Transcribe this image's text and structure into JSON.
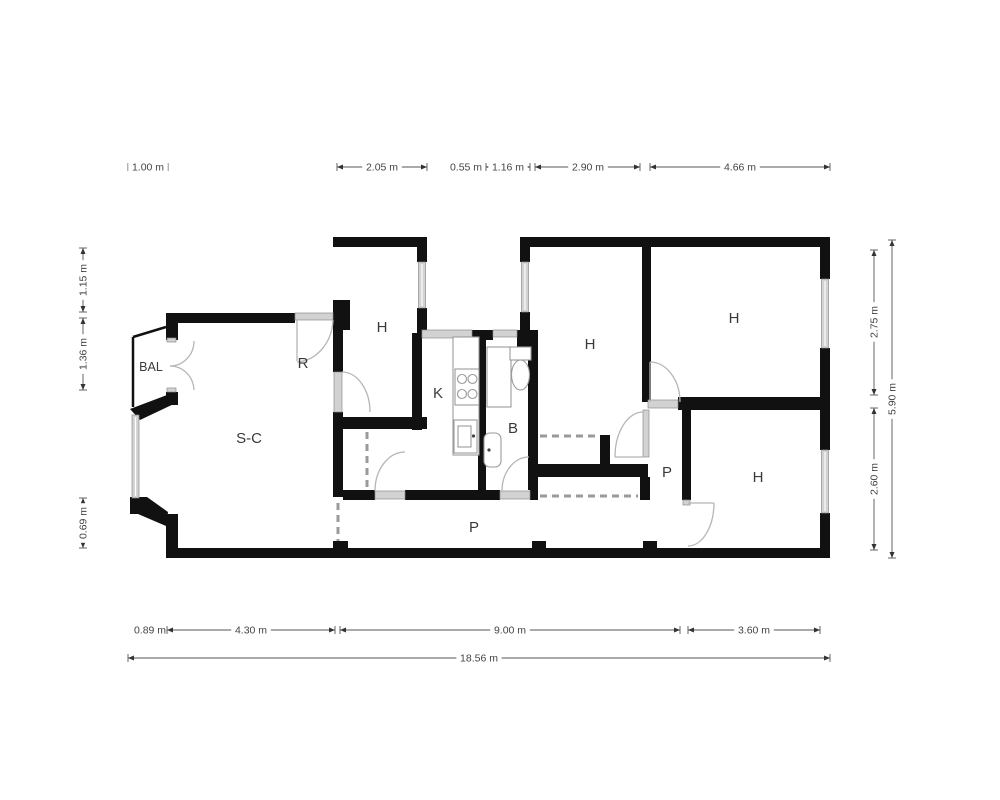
{
  "floorplan": {
    "colors": {
      "wall": "#111111",
      "window": "#d2d2d2",
      "door_arc": "#b5b5b5",
      "dashed_opening": "#9a9a9a",
      "dimension_text": "#444444",
      "room_text": "#3a3a3a",
      "background": "#ffffff"
    },
    "room_labels": [
      {
        "id": "bal",
        "label": "BAL",
        "x": 151,
        "y": 371,
        "size": 12.5
      },
      {
        "id": "sc",
        "label": "S-C",
        "x": 249,
        "y": 443,
        "size": 15
      },
      {
        "id": "r",
        "label": "R",
        "x": 303,
        "y": 368,
        "size": 15
      },
      {
        "id": "h-top-left",
        "label": "H",
        "x": 382,
        "y": 332,
        "size": 15
      },
      {
        "id": "k",
        "label": "K",
        "x": 438,
        "y": 398,
        "size": 15
      },
      {
        "id": "b",
        "label": "B",
        "x": 513,
        "y": 433,
        "size": 15
      },
      {
        "id": "h-middle",
        "label": "H",
        "x": 590,
        "y": 349,
        "size": 15
      },
      {
        "id": "h-top-right",
        "label": "H",
        "x": 734,
        "y": 323,
        "size": 15
      },
      {
        "id": "h-bottom",
        "label": "H",
        "x": 758,
        "y": 482,
        "size": 15
      },
      {
        "id": "p-lobby",
        "label": "P",
        "x": 667,
        "y": 477,
        "size": 15
      },
      {
        "id": "p-corridor",
        "label": "P",
        "x": 474,
        "y": 532,
        "size": 15
      }
    ],
    "dimensions": [
      {
        "id": "top-1",
        "label": "1.00 m",
        "x1": 128,
        "y1": 167,
        "x2": 168,
        "y2": 167,
        "lx": 148,
        "ly": 167,
        "rot": false
      },
      {
        "id": "top-2",
        "label": "2.05 m",
        "x1": 337,
        "y1": 167,
        "x2": 427,
        "y2": 167,
        "lx": 382,
        "ly": 167,
        "rot": false
      },
      {
        "id": "top-3",
        "label": "0.55 m",
        "x1": 455,
        "y1": 167,
        "x2": 481,
        "y2": 167,
        "lx": 466,
        "ly": 167,
        "rot": false
      },
      {
        "id": "top-4",
        "label": "1.16 m",
        "x1": 486,
        "y1": 167,
        "x2": 530,
        "y2": 167,
        "lx": 508,
        "ly": 167,
        "rot": false
      },
      {
        "id": "top-5",
        "label": "2.90 m",
        "x1": 535,
        "y1": 167,
        "x2": 640,
        "y2": 167,
        "lx": 588,
        "ly": 167,
        "rot": false
      },
      {
        "id": "top-6",
        "label": "4.66 m",
        "x1": 650,
        "y1": 167,
        "x2": 830,
        "y2": 167,
        "lx": 740,
        "ly": 167,
        "rot": false
      },
      {
        "id": "bot-1",
        "label": "0.89 m",
        "x1": 133,
        "y1": 630,
        "x2": 167,
        "y2": 630,
        "lx": 150,
        "ly": 630,
        "rot": false
      },
      {
        "id": "bot-2",
        "label": "4.30 m",
        "x1": 167,
        "y1": 630,
        "x2": 335,
        "y2": 630,
        "lx": 251,
        "ly": 630,
        "rot": false
      },
      {
        "id": "bot-3",
        "label": "9.00 m",
        "x1": 340,
        "y1": 630,
        "x2": 680,
        "y2": 630,
        "lx": 510,
        "ly": 630,
        "rot": false
      },
      {
        "id": "bot-4",
        "label": "3.60 m",
        "x1": 688,
        "y1": 630,
        "x2": 820,
        "y2": 630,
        "lx": 754,
        "ly": 630,
        "rot": false
      },
      {
        "id": "total",
        "label": "18.56 m",
        "x1": 128,
        "y1": 658,
        "x2": 830,
        "y2": 658,
        "lx": 479,
        "ly": 658,
        "rot": false
      },
      {
        "id": "right-1",
        "label": "2.75 m",
        "x1": 874,
        "y1": 250,
        "x2": 874,
        "y2": 395,
        "lx": 874,
        "ly": 322,
        "rot": true
      },
      {
        "id": "right-2",
        "label": "2.60 m",
        "x1": 874,
        "y1": 408,
        "x2": 874,
        "y2": 550,
        "lx": 874,
        "ly": 479,
        "rot": true
      },
      {
        "id": "right-3",
        "label": "5.90 m",
        "x1": 892,
        "y1": 240,
        "x2": 892,
        "y2": 558,
        "lx": 892,
        "ly": 399,
        "rot": true
      },
      {
        "id": "left-1",
        "label": "1.15 m",
        "x1": 83,
        "y1": 248,
        "x2": 83,
        "y2": 312,
        "lx": 83,
        "ly": 280,
        "rot": true
      },
      {
        "id": "left-2",
        "label": "1.36 m",
        "x1": 83,
        "y1": 318,
        "x2": 83,
        "y2": 390,
        "lx": 83,
        "ly": 354,
        "rot": true
      },
      {
        "id": "left-3",
        "label": "0.69 m",
        "x1": 83,
        "y1": 498,
        "x2": 83,
        "y2": 548,
        "lx": 83,
        "ly": 523,
        "rot": true
      }
    ]
  }
}
